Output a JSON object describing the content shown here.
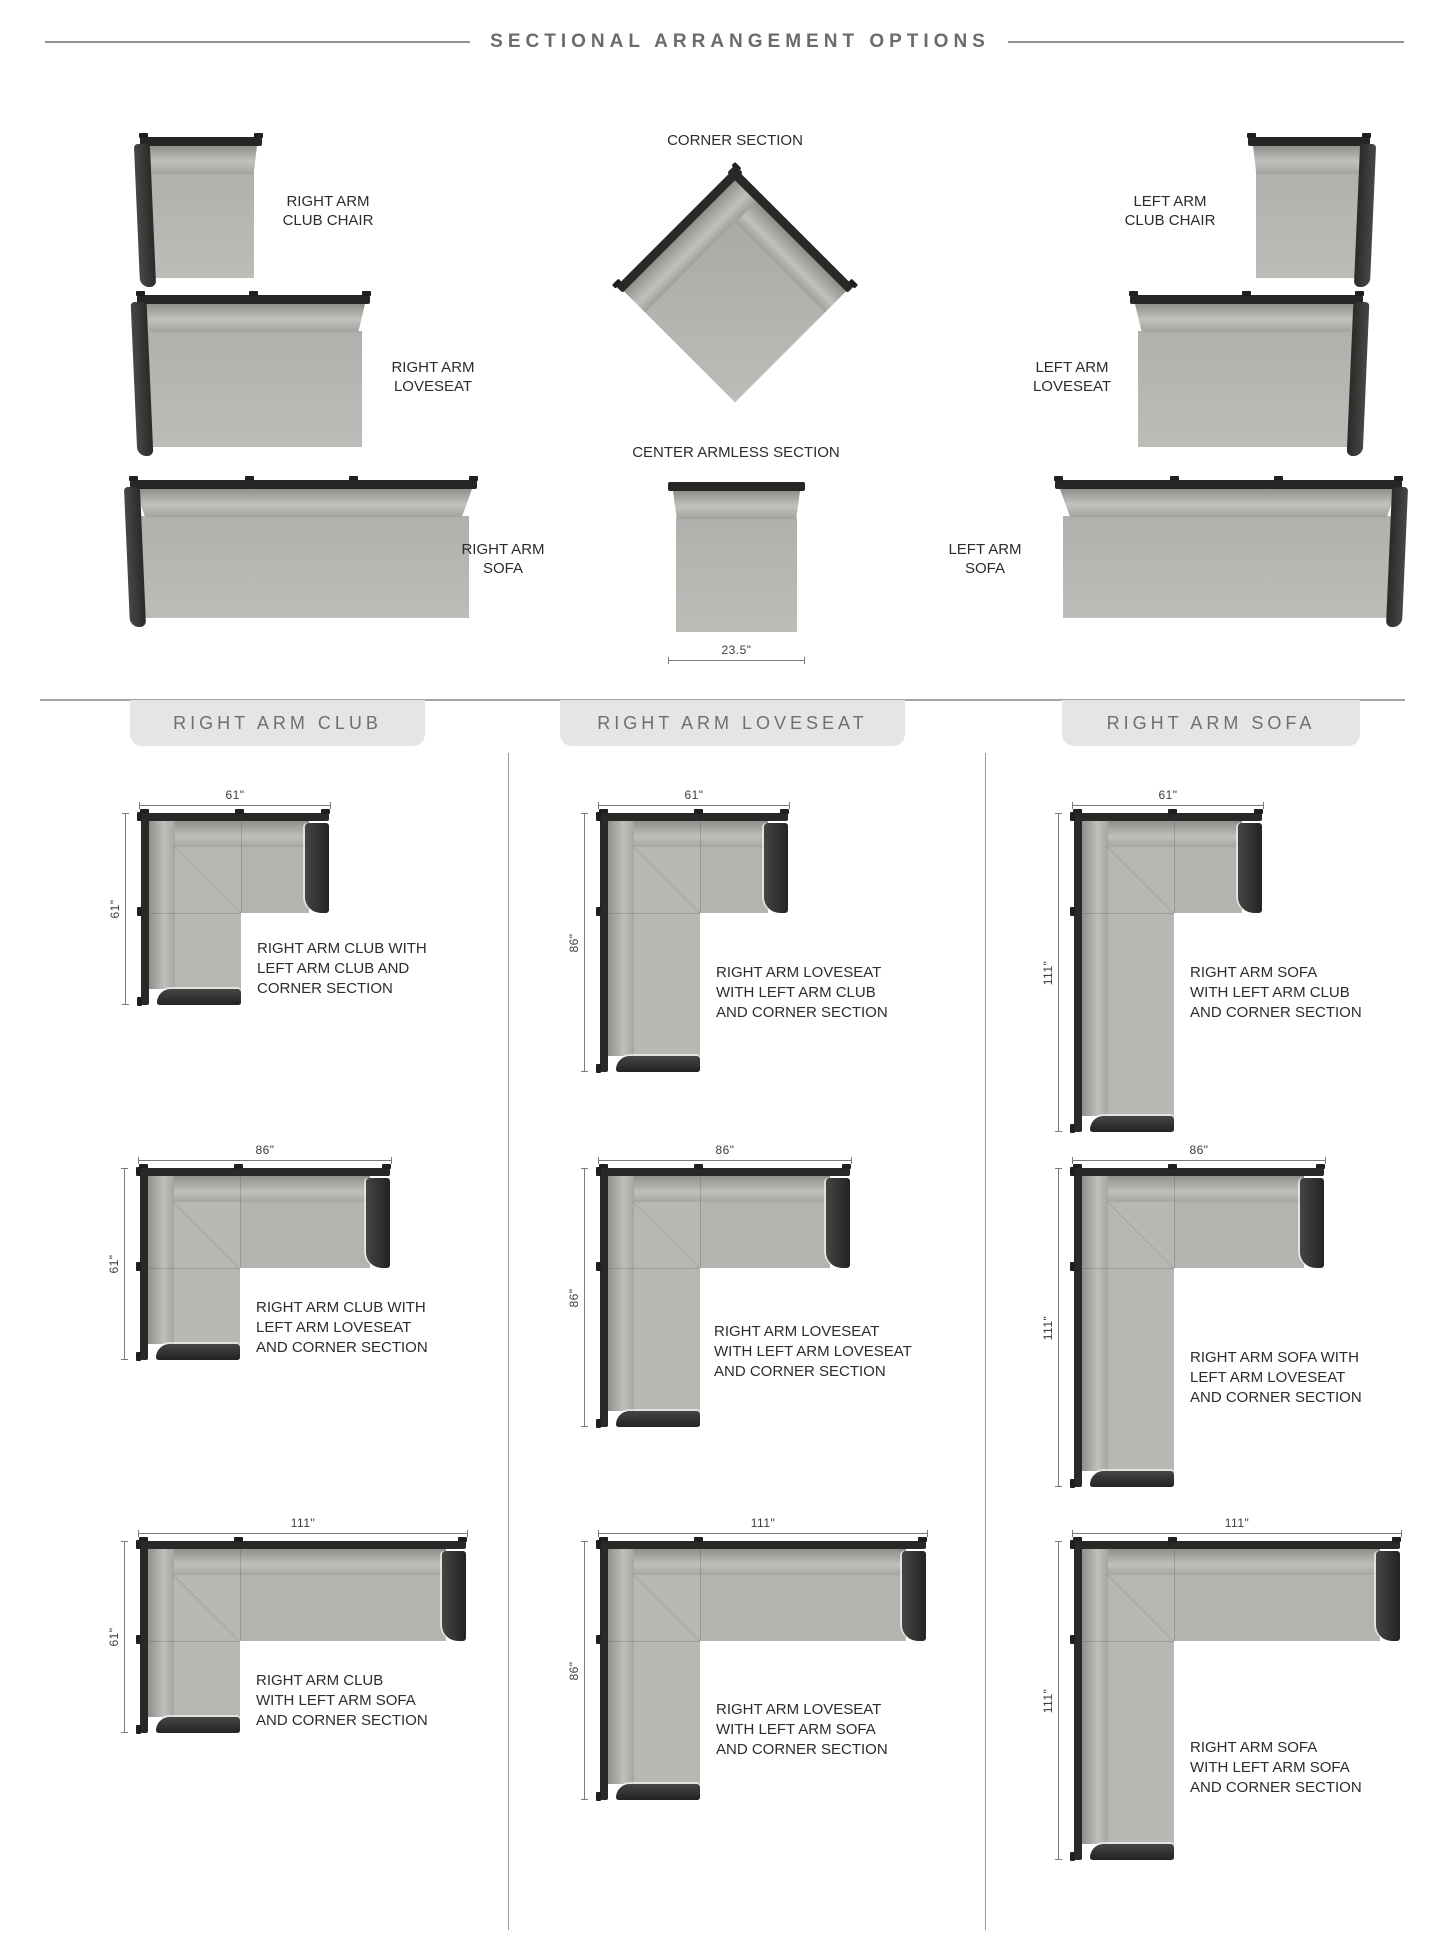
{
  "title": "SECTIONAL ARRANGEMENT OPTIONS",
  "colors": {
    "rail": "#262624",
    "arm": "#2f2f2d",
    "seat": "#b5b5b2",
    "cushion_highlight": "#c1c1be",
    "tab_background": "#e5e5e3",
    "text": "#2c2c2a",
    "muted_title": "#6b6b6b",
    "dimension_line": "#7a7a78"
  },
  "top_section": {
    "pieces": {
      "right_arm_club_chair": {
        "label": "RIGHT ARM\nCLUB CHAIR"
      },
      "right_arm_loveseat": {
        "label": "RIGHT ARM\nLOVESEAT"
      },
      "right_arm_sofa": {
        "label": "RIGHT ARM\nSOFA"
      },
      "left_arm_club_chair": {
        "label": "LEFT ARM\nCLUB CHAIR"
      },
      "left_arm_loveseat": {
        "label": "LEFT ARM\nLOVESEAT"
      },
      "left_arm_sofa": {
        "label": "LEFT ARM\nSOFA"
      },
      "corner_section": {
        "label": "CORNER SECTION"
      },
      "center_armless_section": {
        "label": "CENTER ARMLESS SECTION",
        "width_dim": "23.5\""
      }
    }
  },
  "columns": [
    {
      "header": "RIGHT ARM CLUB",
      "arrangements": [
        {
          "width_dim": "61\"",
          "depth_dim": "61\"",
          "caption": "RIGHT ARM CLUB WITH\nLEFT ARM CLUB AND\nCORNER SECTION"
        },
        {
          "width_dim": "86\"",
          "depth_dim": "61\"",
          "caption": "RIGHT ARM CLUB WITH\nLEFT ARM LOVESEAT\nAND CORNER SECTION"
        },
        {
          "width_dim": "111\"",
          "depth_dim": "61\"",
          "caption": "RIGHT ARM CLUB\nWITH LEFT ARM SOFA\nAND CORNER SECTION"
        }
      ]
    },
    {
      "header": "RIGHT ARM LOVESEAT",
      "arrangements": [
        {
          "width_dim": "61\"",
          "depth_dim": "86\"",
          "caption": "RIGHT ARM LOVESEAT\nWITH LEFT ARM CLUB\nAND CORNER SECTION"
        },
        {
          "width_dim": "86\"",
          "depth_dim": "86\"",
          "caption": "RIGHT ARM LOVESEAT\nWITH LEFT ARM LOVESEAT\nAND CORNER SECTION"
        },
        {
          "width_dim": "111\"",
          "depth_dim": "86\"",
          "caption": "RIGHT ARM LOVESEAT\nWITH LEFT ARM SOFA\nAND CORNER SECTION"
        }
      ]
    },
    {
      "header": "RIGHT ARM SOFA",
      "arrangements": [
        {
          "width_dim": "61\"",
          "depth_dim": "111\"",
          "caption": "RIGHT ARM SOFA\nWITH LEFT ARM CLUB\nAND CORNER SECTION"
        },
        {
          "width_dim": "86\"",
          "depth_dim": "111\"",
          "caption": "RIGHT ARM SOFA WITH\nLEFT ARM LOVESEAT\nAND CORNER SECTION"
        },
        {
          "width_dim": "111\"",
          "depth_dim": "111\"",
          "caption": "RIGHT ARM SOFA\nWITH LEFT ARM SOFA\nAND CORNER SECTION"
        }
      ]
    }
  ]
}
